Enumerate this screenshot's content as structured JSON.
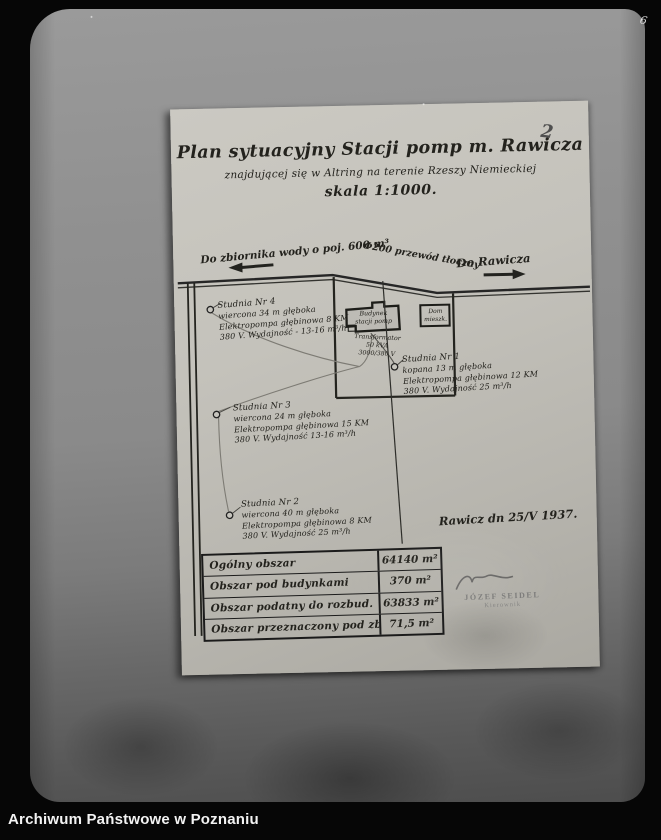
{
  "photo": {
    "pencil_page_number": "2",
    "edge_mark": "6"
  },
  "plan": {
    "title": "Plan sytuacyjny Stacji pomp m. Rawicza",
    "subtitle": "znajdującej się w Altring na terenie Rzeszy Niemieckiej",
    "scale_line": "skala 1:1000.",
    "date_note": "Rawicz dn 25/V 1937."
  },
  "map": {
    "road_left_label": "Do zbiornika wody o poj. 600 m³",
    "pipeline_label": "Φ200 przewód tłoczny",
    "road_right_label": "Do Rawicza",
    "building": [
      "Budynek",
      "stacji pomp"
    ],
    "house": [
      "Dom",
      "mieszk."
    ],
    "transformer": [
      "Transformator",
      "50 kVA",
      "3000/380 V"
    ],
    "wells": [
      {
        "name": "studnia-4",
        "lines": [
          "Studnia Nr 4",
          "wiercona 34 m głęboka",
          "Elektropompa głębinowa 8 KM",
          "380 V. Wydajność - 13-16 m³/h"
        ]
      },
      {
        "name": "studnia-1",
        "lines": [
          "Studnia Nr 1",
          "kopana 13 m głęboka",
          "Elektropompa głębinowa 12 KM",
          "380 V. Wydajność 25 m³/h"
        ]
      },
      {
        "name": "studnia-3",
        "lines": [
          "Studnia Nr 3",
          "wiercona 24 m głęboka",
          "Elektropompa głębinowa 15 KM",
          "380 V. Wydajność 13-16 m³/h"
        ]
      },
      {
        "name": "studnia-2",
        "lines": [
          "Studnia Nr 2",
          "wiercona 40 m głęboka",
          "Elektropompa głębinowa 8 KM",
          "380 V. Wydajność 25 m³/h"
        ]
      }
    ]
  },
  "stamp": {
    "name": "JÓZEF SEIDEL",
    "title": "Kierownik"
  },
  "area_table": {
    "rows": [
      {
        "label": "Ogólny obszar",
        "value": "64140 m²"
      },
      {
        "label": "Obszar pod budynkami",
        "value": "370 m²"
      },
      {
        "label": "Obszar podatny do rozbud.",
        "value": "63833 m²"
      },
      {
        "label": "Obszar przeznaczony pod zbiorn.",
        "value": "71,5 m²"
      }
    ]
  },
  "footer": {
    "archive_name": "Archiwum Państwowe w Poznaniu"
  },
  "colors": {
    "ink": "#20201c",
    "pipe": "#7d7b74",
    "paper": "#c2c0b9",
    "plate": "#8a8a8a",
    "frame": "#070707",
    "pencil": "#4f4f4f"
  }
}
